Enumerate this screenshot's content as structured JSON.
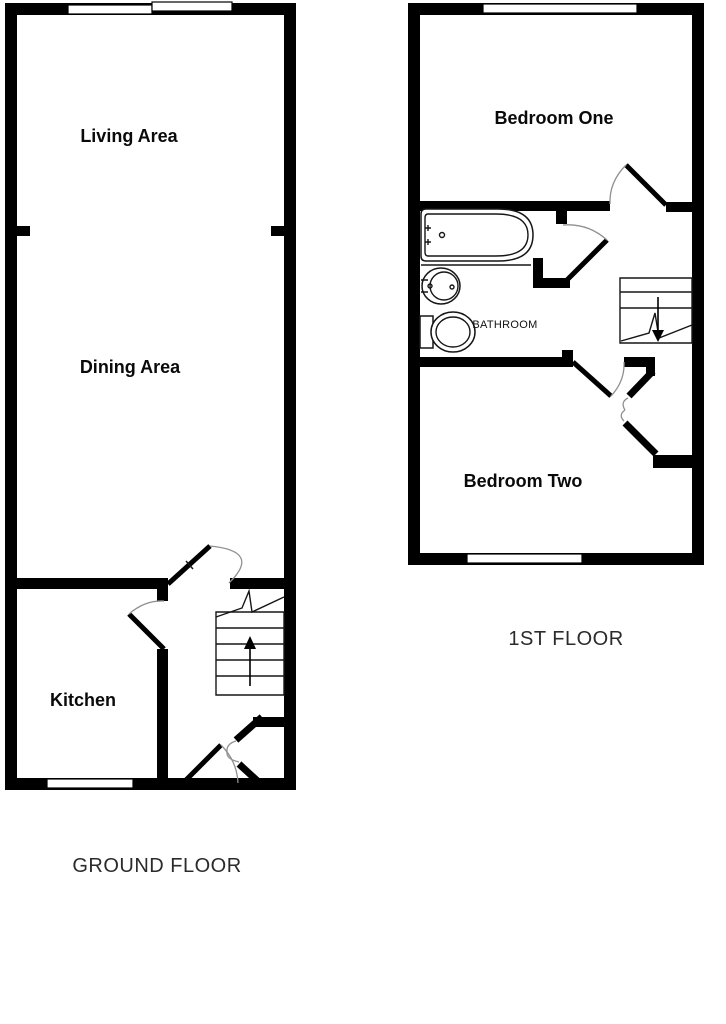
{
  "colors": {
    "background": "#ffffff",
    "wall": "#000000",
    "line": "#161616",
    "door_arc": "#909090",
    "room_label_text": "#0a0a0a",
    "floor_title_text": "#2b2b2b"
  },
  "floors": [
    {
      "title": "GROUND FLOOR",
      "rooms": [
        {
          "label": "Living Area"
        },
        {
          "label": "Dining Area"
        },
        {
          "label": "Kitchen"
        }
      ],
      "features": {
        "stairs": "up-arrow",
        "windows": 3,
        "external_doors": 1
      }
    },
    {
      "title": "1ST FLOOR",
      "rooms": [
        {
          "label": "Bedroom One"
        },
        {
          "label": "BATHROOM"
        },
        {
          "label": "Bedroom Two"
        }
      ],
      "features": {
        "stairs": "down-arrow",
        "windows": 2,
        "fixtures": [
          "bathtub",
          "sink",
          "toilet"
        ]
      }
    }
  ]
}
